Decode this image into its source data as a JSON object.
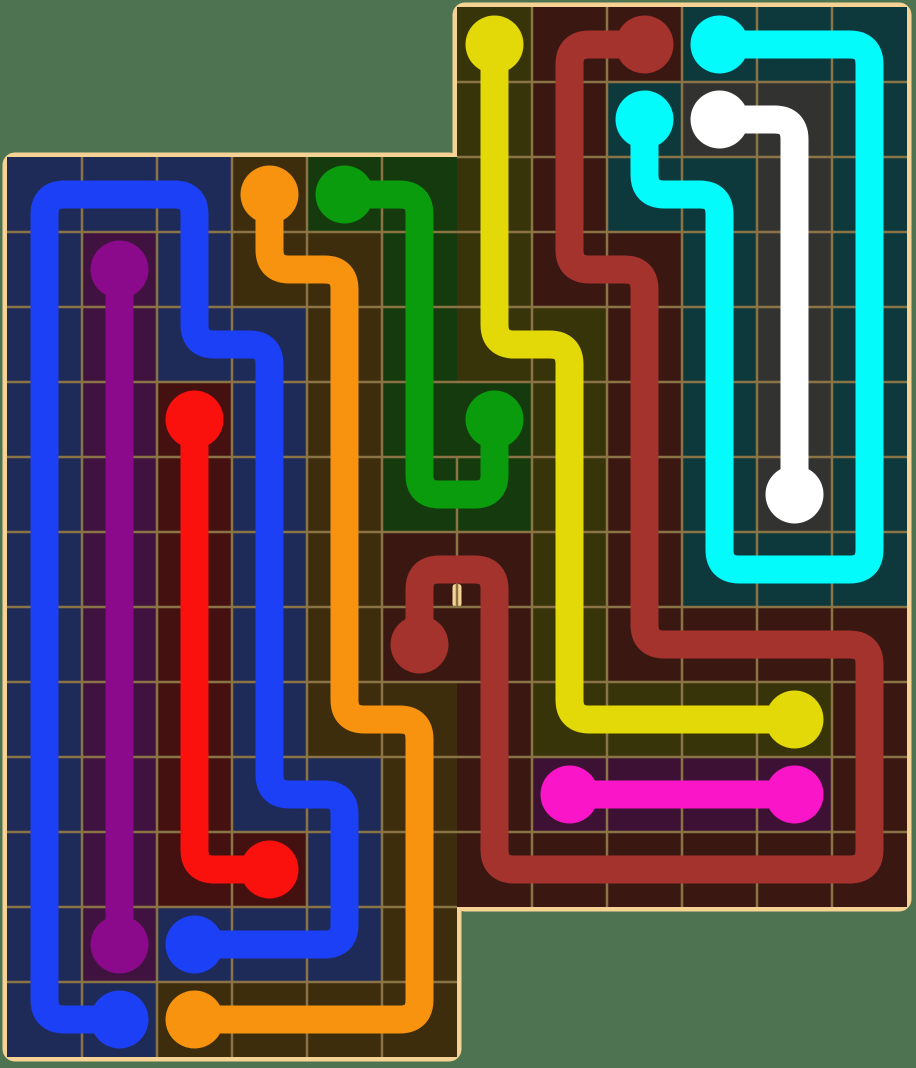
{
  "canvas": {
    "width": 916,
    "height": 1068,
    "background_color": "#4d7351"
  },
  "board": {
    "origin_x": 7,
    "origin_y": 7,
    "cell_w": 75,
    "cell_h": 75,
    "border_width": 9,
    "border_color": "#f6d394",
    "board_fill": "#241b10",
    "grid_line_color": "#8a7445",
    "grid_line_width": 2.5,
    "pipe_width": 28,
    "dot_radius": 29,
    "corner_radius": 8,
    "pipe_corner_radius": 20,
    "sections": [
      {
        "name": "left-board",
        "col_start": 0,
        "col_end": 5,
        "row_start": 2,
        "row_end": 13
      },
      {
        "name": "right-board",
        "col_start": 6,
        "col_end": 11,
        "row_start": 0,
        "row_end": 11
      }
    ],
    "shared_edge_col": 6,
    "gap_rows": [
      6,
      7
    ],
    "border_stub": {
      "y_from": 584,
      "y_to": 607
    }
  },
  "flows": [
    {
      "name": "blue",
      "color": "#1c40f5",
      "tint": "#1e2a58",
      "path": [
        [
          2,
          12
        ],
        [
          3,
          12
        ],
        [
          4,
          12
        ],
        [
          4,
          11
        ],
        [
          4,
          10
        ],
        [
          3,
          10
        ],
        [
          3,
          9
        ],
        [
          3,
          8
        ],
        [
          3,
          7
        ],
        [
          3,
          6
        ],
        [
          3,
          5
        ],
        [
          3,
          4
        ],
        [
          2,
          4
        ],
        [
          2,
          3
        ],
        [
          2,
          2
        ],
        [
          1,
          2
        ],
        [
          0,
          2
        ],
        [
          0,
          3
        ],
        [
          0,
          4
        ],
        [
          0,
          5
        ],
        [
          0,
          6
        ],
        [
          0,
          7
        ],
        [
          0,
          8
        ],
        [
          0,
          9
        ],
        [
          0,
          10
        ],
        [
          0,
          11
        ],
        [
          0,
          12
        ],
        [
          0,
          13
        ],
        [
          1,
          13
        ]
      ]
    },
    {
      "name": "purple",
      "color": "#8b0a8b",
      "tint": "#3f1240",
      "path": [
        [
          1,
          3
        ],
        [
          1,
          4
        ],
        [
          1,
          5
        ],
        [
          1,
          6
        ],
        [
          1,
          7
        ],
        [
          1,
          8
        ],
        [
          1,
          9
        ],
        [
          1,
          10
        ],
        [
          1,
          11
        ],
        [
          1,
          12
        ]
      ]
    },
    {
      "name": "red",
      "color": "#fa100d",
      "tint": "#441110",
      "path": [
        [
          2,
          5
        ],
        [
          2,
          6
        ],
        [
          2,
          7
        ],
        [
          2,
          8
        ],
        [
          2,
          9
        ],
        [
          2,
          10
        ],
        [
          2,
          11
        ],
        [
          3,
          11
        ]
      ]
    },
    {
      "name": "orange",
      "color": "#f8930f",
      "tint": "#3d2d0d",
      "path": [
        [
          3,
          2
        ],
        [
          3,
          3
        ],
        [
          4,
          3
        ],
        [
          4,
          4
        ],
        [
          4,
          5
        ],
        [
          4,
          6
        ],
        [
          4,
          7
        ],
        [
          4,
          8
        ],
        [
          4,
          9
        ],
        [
          5,
          9
        ],
        [
          5,
          10
        ],
        [
          5,
          11
        ],
        [
          5,
          12
        ],
        [
          5,
          13
        ],
        [
          4,
          13
        ],
        [
          3,
          13
        ],
        [
          2,
          13
        ]
      ]
    },
    {
      "name": "green",
      "color": "#0a9c0d",
      "tint": "#153a0d",
      "path": [
        [
          4,
          2
        ],
        [
          5,
          2
        ],
        [
          5,
          3
        ],
        [
          5,
          4
        ],
        [
          5,
          5
        ],
        [
          5,
          6
        ],
        [
          6,
          6
        ],
        [
          6,
          5
        ]
      ]
    },
    {
      "name": "yellow",
      "color": "#e3d908",
      "tint": "#38340a",
      "path": [
        [
          6,
          0
        ],
        [
          6,
          1
        ],
        [
          6,
          2
        ],
        [
          6,
          3
        ],
        [
          6,
          4
        ],
        [
          7,
          4
        ],
        [
          7,
          5
        ],
        [
          7,
          6
        ],
        [
          7,
          7
        ],
        [
          7,
          8
        ],
        [
          7,
          9
        ],
        [
          8,
          9
        ],
        [
          9,
          9
        ],
        [
          10,
          9
        ]
      ]
    },
    {
      "name": "dark-red",
      "color": "#a5332d",
      "tint": "#3b1712",
      "path": [
        [
          8,
          0
        ],
        [
          7,
          0
        ],
        [
          7,
          1
        ],
        [
          7,
          2
        ],
        [
          7,
          3
        ],
        [
          8,
          3
        ],
        [
          8,
          4
        ],
        [
          8,
          5
        ],
        [
          8,
          6
        ],
        [
          8,
          7
        ],
        [
          8,
          8
        ],
        [
          9,
          8
        ],
        [
          10,
          8
        ],
        [
          11,
          8
        ],
        [
          11,
          9
        ],
        [
          11,
          10
        ],
        [
          11,
          11
        ],
        [
          10,
          11
        ],
        [
          9,
          11
        ],
        [
          8,
          11
        ],
        [
          7,
          11
        ],
        [
          6,
          11
        ],
        [
          6,
          10
        ],
        [
          6,
          9
        ],
        [
          6,
          8
        ],
        [
          6,
          7
        ],
        [
          5,
          7
        ],
        [
          5,
          8
        ]
      ]
    },
    {
      "name": "cyan",
      "color": "#03fbfb",
      "tint": "#0d393c",
      "path": [
        [
          9,
          0
        ],
        [
          10,
          0
        ],
        [
          11,
          0
        ],
        [
          11,
          1
        ],
        [
          11,
          2
        ],
        [
          11,
          3
        ],
        [
          11,
          4
        ],
        [
          11,
          5
        ],
        [
          11,
          6
        ],
        [
          11,
          7
        ],
        [
          10,
          7
        ],
        [
          9,
          7
        ],
        [
          9,
          6
        ],
        [
          9,
          5
        ],
        [
          9,
          4
        ],
        [
          9,
          3
        ],
        [
          9,
          2
        ],
        [
          8,
          2
        ],
        [
          8,
          1
        ]
      ]
    },
    {
      "name": "white",
      "color": "#ffffff",
      "tint": "#323330",
      "path": [
        [
          9,
          1
        ],
        [
          10,
          1
        ],
        [
          10,
          2
        ],
        [
          10,
          3
        ],
        [
          10,
          4
        ],
        [
          10,
          5
        ],
        [
          10,
          6
        ]
      ]
    },
    {
      "name": "magenta",
      "color": "#fa16c8",
      "tint": "#3c1134",
      "path": [
        [
          7,
          10
        ],
        [
          8,
          10
        ],
        [
          9,
          10
        ],
        [
          10,
          10
        ]
      ]
    }
  ]
}
